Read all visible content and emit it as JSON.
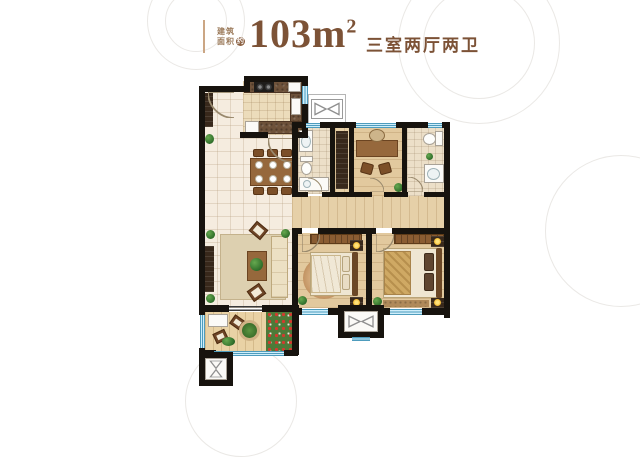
{
  "title": {
    "area_label_line1": "建筑",
    "area_label_line2": "面积",
    "area_label_badge": "约",
    "area_value": "103m",
    "area_superscript": "2",
    "layout_text": "三室两厅两卫"
  },
  "colors": {
    "accent_brown": "#7c5236",
    "divider_tan": "#cba684",
    "wall_black": "#17130e",
    "window_blue": "#cfeefa",
    "floor_tile": "#f5ecdf",
    "floor_wood": "#e2c99e"
  },
  "floorplan": {
    "elements": [
      [
        "tile",
        "entry-dining-living-floor",
        204,
        90,
        88,
        218
      ],
      [
        "kitchenfloor",
        "kitchen-floor",
        243,
        81,
        60,
        54
      ],
      [
        "bathfloor",
        "bath-main-floor",
        298,
        128,
        34,
        66
      ],
      [
        "woodv",
        "hall-closet-floor",
        335,
        128,
        15,
        68
      ],
      [
        "wood",
        "study-floor",
        354,
        128,
        48,
        68
      ],
      [
        "bathfloor",
        "bath-master-floor",
        407,
        128,
        37,
        68
      ],
      [
        "woodv",
        "corridor-floor",
        292,
        196,
        152,
        32
      ],
      [
        "wood",
        "bedroom-second-floor",
        298,
        233,
        68,
        75
      ],
      [
        "wood",
        "bedroom-master-floor",
        372,
        233,
        72,
        75
      ],
      [
        "balconyfloor",
        "balcony-floor",
        205,
        312,
        88,
        40
      ],
      [
        "outline",
        "ac-platform",
        308,
        94,
        38,
        30
      ],
      [
        "bowtiebox",
        "flue-top-symbol",
        311,
        99,
        32,
        20
      ],
      [
        "rug",
        "living-rug",
        220,
        234,
        66,
        66
      ],
      [
        "ruground",
        "bedroom-second-rug",
        303,
        257,
        42,
        42
      ],
      [
        "dark",
        "shoe-cabinet",
        205,
        93,
        8,
        34
      ],
      [
        "green",
        "entry-plant",
        205,
        134,
        9,
        10
      ],
      [
        "dark",
        "tv-cabinet",
        205,
        246,
        9,
        46
      ],
      [
        "woodfurn",
        "coffee-table",
        247,
        251,
        20,
        30
      ],
      [
        "green",
        "coffee-table-plant",
        250,
        258,
        13,
        13
      ],
      [
        "cream",
        "sofa",
        271,
        236,
        17,
        62
      ],
      [
        "chairdiag",
        "accent-chair-top",
        251,
        224,
        15,
        13,
        40
      ],
      [
        "chairdiag",
        "accent-chair-bottom",
        249,
        286,
        15,
        13,
        -35
      ],
      [
        "green",
        "living-plant-top",
        206,
        230,
        9,
        9
      ],
      [
        "green",
        "living-plant-bottom",
        206,
        294,
        9,
        9
      ],
      [
        "green",
        "living-plant-right",
        281,
        229,
        9,
        9
      ],
      [
        "counter",
        "kitchen-counter-top",
        244,
        81,
        58,
        12
      ],
      [
        "stove",
        "stove",
        254,
        82,
        20,
        10
      ],
      [
        "white",
        "kitchen-sink-top",
        288,
        82,
        13,
        10
      ],
      [
        "counter",
        "kitchen-counter-right",
        290,
        93,
        12,
        30
      ],
      [
        "white",
        "kitchen-sink-right",
        291,
        98,
        10,
        17
      ],
      [
        "counter",
        "kitchen-counter-bottom",
        258,
        121,
        44,
        13
      ],
      [
        "white",
        "fridge",
        245,
        121,
        14,
        13
      ],
      [
        "woodfurn",
        "dining-table",
        250,
        158,
        44,
        28
      ],
      [
        "plate",
        "dinner-plate",
        255,
        161,
        8,
        8
      ],
      [
        "plate",
        "dinner-plate",
        269,
        161,
        8,
        8
      ],
      [
        "plate",
        "dinner-plate",
        283,
        161,
        8,
        8
      ],
      [
        "plate",
        "dinner-plate",
        255,
        175,
        8,
        8
      ],
      [
        "plate",
        "dinner-plate",
        269,
        175,
        8,
        8
      ],
      [
        "plate",
        "dinner-plate",
        283,
        175,
        8,
        8
      ],
      [
        "chairb",
        "dining-chair",
        253,
        149,
        11,
        8
      ],
      [
        "chairb",
        "dining-chair",
        267,
        149,
        11,
        8
      ],
      [
        "chairb",
        "dining-chair",
        281,
        149,
        11,
        8
      ],
      [
        "chairb",
        "dining-chair",
        253,
        187,
        11,
        8
      ],
      [
        "chairb",
        "dining-chair",
        267,
        187,
        11,
        8
      ],
      [
        "chairb",
        "dining-chair",
        281,
        187,
        11,
        8
      ],
      [
        "white",
        "bath-main-sink",
        299,
        130,
        14,
        22
      ],
      [
        "basin",
        "bath-main-sink-basin",
        301,
        135,
        10,
        13
      ],
      [
        "white",
        "bath-main-toilet-tank",
        300,
        156,
        13,
        6
      ],
      [
        "bowl",
        "bath-main-toilet-bowl",
        301,
        162,
        11,
        13
      ],
      [
        "white",
        "bath-main-shower",
        299,
        177,
        30,
        14
      ],
      [
        "basin",
        "bath-main-shower-drain",
        303,
        180,
        8,
        8
      ],
      [
        "dark",
        "hall-bookshelf",
        336,
        131,
        12,
        58
      ],
      [
        "woodfurn",
        "study-desk",
        356,
        140,
        42,
        17
      ],
      [
        "chairround",
        "study-chair",
        369,
        129,
        16,
        13
      ],
      [
        "chairb",
        "study-guest-chair-1",
        361,
        163,
        12,
        11,
        15
      ],
      [
        "chairb",
        "study-guest-chair-2",
        379,
        163,
        12,
        11,
        -15
      ],
      [
        "green",
        "study-plant",
        394,
        183,
        9,
        9
      ],
      [
        "white",
        "bath-master-toilet-tank",
        435,
        131,
        8,
        15
      ],
      [
        "bowl",
        "bath-master-toilet-bowl",
        423,
        133,
        13,
        12
      ],
      [
        "white",
        "bath-master-sink",
        424,
        164,
        20,
        19
      ],
      [
        "basin",
        "bath-master-sink-basin",
        427,
        168,
        13,
        12
      ],
      [
        "green",
        "bath-master-plant",
        426,
        153,
        7,
        7
      ],
      [
        "wardrobe",
        "bedroom-second-wardrobe",
        310,
        234,
        52,
        10
      ],
      [
        "bedbase",
        "bedroom-second-bed",
        310,
        252,
        48,
        44
      ],
      [
        "duvet",
        "bedroom-second-duvet",
        311,
        255,
        30,
        38
      ],
      [
        "pillow",
        "bedroom-second-pillow-1",
        342,
        256,
        8,
        16
      ],
      [
        "pillow",
        "bedroom-second-pillow-2",
        342,
        274,
        8,
        16
      ],
      [
        "headboard",
        "bedroom-second-headboard",
        352,
        252,
        6,
        44
      ],
      [
        "dark",
        "bedroom-second-nightstand-1",
        350,
        240,
        13,
        11
      ],
      [
        "lamp",
        "bedroom-second-lamp-1",
        353,
        242,
        7,
        7
      ],
      [
        "dark",
        "bedroom-second-nightstand-2",
        350,
        297,
        13,
        11
      ],
      [
        "lamp",
        "bedroom-second-lamp-2",
        353,
        299,
        7,
        7
      ],
      [
        "green",
        "bedroom-second-plant",
        298,
        296,
        9,
        9
      ],
      [
        "wardrobe",
        "bedroom-master-wardrobe",
        394,
        234,
        50,
        10
      ],
      [
        "bedbase",
        "bedroom-master-bed",
        383,
        248,
        59,
        50
      ],
      [
        "duvetgold",
        "bedroom-master-duvet",
        384,
        251,
        27,
        44
      ],
      [
        "pillowdark",
        "bedroom-master-pillow-1",
        424,
        253,
        10,
        18
      ],
      [
        "pillowdark",
        "bedroom-master-pillow-2",
        424,
        273,
        10,
        18
      ],
      [
        "headboard",
        "bedroom-master-headboard",
        436,
        248,
        6,
        50
      ],
      [
        "dark",
        "bedroom-master-nightstand-1",
        431,
        236,
        13,
        11
      ],
      [
        "lamp",
        "bedroom-master-lamp-1",
        434,
        238,
        7,
        7
      ],
      [
        "dark",
        "bedroom-master-nightstand-2",
        431,
        298,
        13,
        10
      ],
      [
        "lamp",
        "bedroom-master-lamp-2",
        434,
        299,
        7,
        7
      ],
      [
        "rugb",
        "bedroom-master-rug",
        383,
        300,
        46,
        7
      ],
      [
        "green",
        "bedroom-master-plant",
        373,
        297,
        9,
        9
      ],
      [
        "white",
        "balcony-bench",
        208,
        314,
        20,
        13
      ],
      [
        "chairdiag",
        "balcony-chair-1",
        231,
        317,
        13,
        11,
        35
      ],
      [
        "chairdiag",
        "balcony-chair-2",
        214,
        331,
        13,
        11,
        -25
      ],
      [
        "plantertable",
        "balcony-plant-table",
        239,
        320,
        21,
        21
      ],
      [
        "flower",
        "balcony-flower-bed",
        266,
        311,
        26,
        40
      ],
      [
        "green",
        "balcony-plant",
        222,
        337,
        13,
        9
      ],
      [
        "wall",
        "wall-outer-left",
        199,
        86,
        6,
        229
      ],
      [
        "wall",
        "wall-entry-top",
        199,
        86,
        50,
        6
      ],
      [
        "wall",
        "wall-kitchen-jog",
        244,
        76,
        6,
        16
      ],
      [
        "wall",
        "wall-kitchen-top",
        244,
        76,
        64,
        6
      ],
      [
        "wall",
        "wall-kitchen-right-upper",
        302,
        76,
        6,
        10
      ],
      [
        "winv",
        "window-kitchen",
        302,
        86,
        6,
        18
      ],
      [
        "wall",
        "wall-kitchen-right-lower",
        302,
        104,
        6,
        34
      ],
      [
        "wall",
        "wall-kitchen-bottom-left",
        240,
        132,
        28,
        6
      ],
      [
        "wall",
        "wall-kitchen-bottom-right",
        292,
        132,
        16,
        6
      ],
      [
        "wall",
        "wall-wing-top-1",
        292,
        122,
        14,
        6
      ],
      [
        "winh",
        "window-bath-main",
        306,
        123,
        14,
        5
      ],
      [
        "wall",
        "wall-wing-top-2",
        320,
        122,
        36,
        6
      ],
      [
        "winh",
        "window-study",
        356,
        123,
        40,
        5
      ],
      [
        "wall",
        "wall-wing-top-3",
        396,
        122,
        32,
        6
      ],
      [
        "winh",
        "window-bath-master",
        428,
        123,
        14,
        5
      ],
      [
        "wall",
        "wall-wing-top-4",
        442,
        122,
        8,
        6
      ],
      [
        "wall",
        "wall-outer-right",
        444,
        122,
        6,
        196
      ],
      [
        "wall",
        "wall-bath-main-left",
        292,
        122,
        6,
        74
      ],
      [
        "wall",
        "wall-bath-main-right",
        330,
        128,
        5,
        68
      ],
      [
        "wall",
        "wall-study-left",
        349,
        122,
        5,
        74
      ],
      [
        "wall",
        "wall-study-right",
        402,
        122,
        5,
        74
      ],
      [
        "wall",
        "wall-wing-bottom-1",
        292,
        192,
        16,
        5
      ],
      [
        "wall",
        "wall-wing-bottom-2",
        322,
        192,
        50,
        5
      ],
      [
        "wall",
        "wall-wing-bottom-3",
        384,
        192,
        24,
        5
      ],
      [
        "wall",
        "wall-wing-bottom-4",
        424,
        192,
        20,
        5
      ],
      [
        "wall",
        "wall-bedrooms-top-1",
        292,
        228,
        10,
        6
      ],
      [
        "wall",
        "wall-bedrooms-top-2",
        318,
        228,
        58,
        6
      ],
      [
        "wall",
        "wall-bedrooms-top-3",
        392,
        228,
        52,
        6
      ],
      [
        "wall",
        "wall-living-bedroom-divider",
        292,
        228,
        6,
        80
      ],
      [
        "wall",
        "wall-bedroom-divider",
        366,
        233,
        6,
        75
      ],
      [
        "wall",
        "wall-bedrooms-bottom-1",
        292,
        308,
        10,
        7
      ],
      [
        "winh",
        "window-bedroom-second",
        302,
        309,
        26,
        6
      ],
      [
        "wall",
        "wall-bedrooms-bottom-2",
        328,
        308,
        14,
        7
      ],
      [
        "wall",
        "wall-bedrooms-bottom-3",
        380,
        308,
        10,
        7
      ],
      [
        "winh",
        "window-bedroom-master",
        390,
        309,
        32,
        6
      ],
      [
        "wall",
        "wall-bedrooms-bottom-4",
        422,
        308,
        26,
        7
      ],
      [
        "wall",
        "wall-living-bottom-left",
        199,
        305,
        30,
        7
      ],
      [
        "slider",
        "balcony-slider",
        229,
        306,
        33,
        5
      ],
      [
        "wall",
        "wall-living-bottom-right",
        262,
        305,
        34,
        7
      ],
      [
        "wall",
        "wall-balcony-right",
        292,
        305,
        7,
        50
      ],
      [
        "winv",
        "window-balcony-left",
        200,
        315,
        5,
        33
      ],
      [
        "wall",
        "wall-balcony-corner",
        199,
        348,
        6,
        8
      ],
      [
        "wall",
        "wall-balcony-bottom-left",
        204,
        350,
        12,
        6
      ],
      [
        "winh",
        "window-balcony-bottom",
        214,
        351,
        72,
        5
      ],
      [
        "wall",
        "wall-balcony-bottom-right",
        284,
        350,
        14,
        6
      ],
      [
        "wall",
        "flue-left-frame",
        199,
        352,
        34,
        34
      ],
      [
        "white",
        "flue-left-inner",
        205,
        358,
        22,
        22
      ],
      [
        "bowtiev",
        "flue-left-symbol",
        207,
        359,
        18,
        20
      ],
      [
        "wall",
        "flue-bottom-frame",
        338,
        305,
        46,
        33
      ],
      [
        "white",
        "flue-bottom-inner",
        344,
        311,
        34,
        21
      ],
      [
        "bowtieh",
        "flue-bottom-symbol",
        346,
        313,
        30,
        17
      ],
      [
        "winh",
        "window-flue-bottom",
        352,
        337,
        18,
        4
      ],
      [
        "arc",
        "door-entry",
        208,
        92,
        26,
        26,
        90
      ],
      [
        "arc",
        "door-kitchen",
        268,
        138,
        24,
        24,
        90
      ],
      [
        "arc",
        "door-bath-main",
        308,
        178,
        14,
        14,
        270
      ],
      [
        "arc",
        "door-study",
        370,
        178,
        14,
        14,
        270
      ],
      [
        "arc",
        "door-bath-master",
        408,
        177,
        15,
        15,
        270
      ],
      [
        "arc",
        "door-bedroom-second",
        302,
        234,
        18,
        18,
        0
      ],
      [
        "arc",
        "door-bedroom-master",
        376,
        234,
        18,
        18,
        0
      ]
    ]
  }
}
